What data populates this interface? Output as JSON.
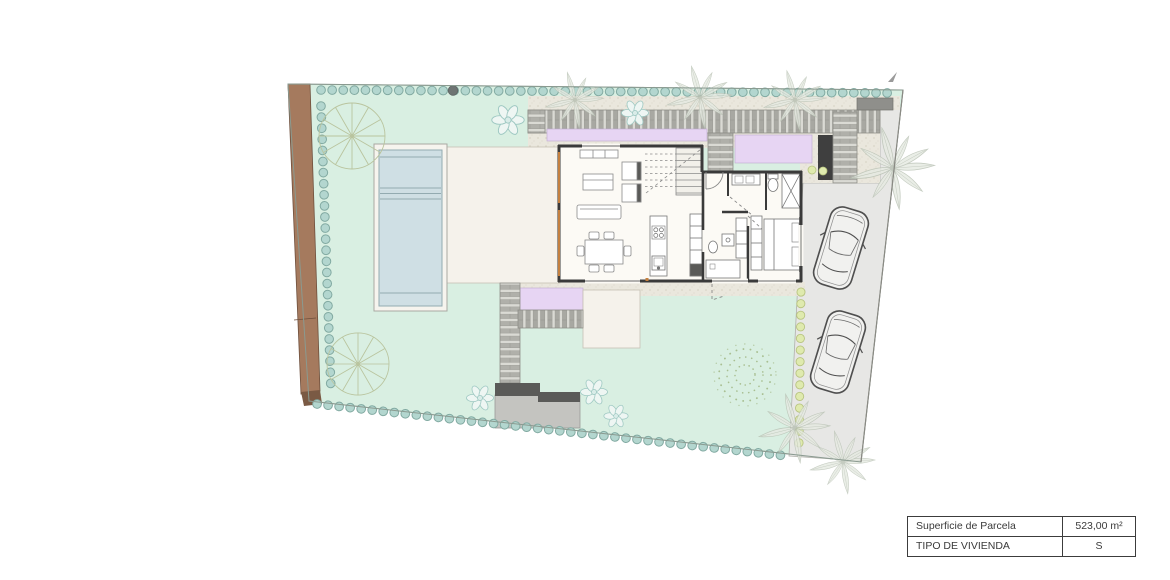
{
  "info_table": {
    "rows": [
      {
        "label": "Superficie de Parcela",
        "value": "523,00 m²"
      },
      {
        "label": "TIPO DE VIVIENDA",
        "value": "S"
      }
    ]
  },
  "plan": {
    "type": "villa-site-plan",
    "colors": {
      "garden": "#d9efe2",
      "pool_water": "#cfdfe4",
      "pool_deck": "#f6f4ee",
      "terrace": "#f5f2eb",
      "house_floor": "#fcfaf5",
      "wall": "#3a3a3a",
      "walkway_purple": "#e7d5f3",
      "driveway": "#e7e7e5",
      "wood_fence": "#a57a5e",
      "wood_fence_cap": "#7a5a44",
      "hedge_dot": "#b3d6cf",
      "hedge_dot_edge": "#82aaa2",
      "shrub_dot": "#dfeaae",
      "shrub_dot_edge": "#b8c480",
      "platform_dark": "#5a5a58",
      "platform_light": "#c4c4c0",
      "door_frame": "#c4803f",
      "tree_stroke": "#b9c49e",
      "palm_stroke": "#b7c0b2",
      "car_stroke": "#4f4f4f"
    },
    "features": {
      "cars_parked": 2,
      "round_trees": 2,
      "pool": "rectangular swimming pool with steps",
      "table_caption_area": "523,00 m²",
      "table_caption_type": "S"
    }
  }
}
